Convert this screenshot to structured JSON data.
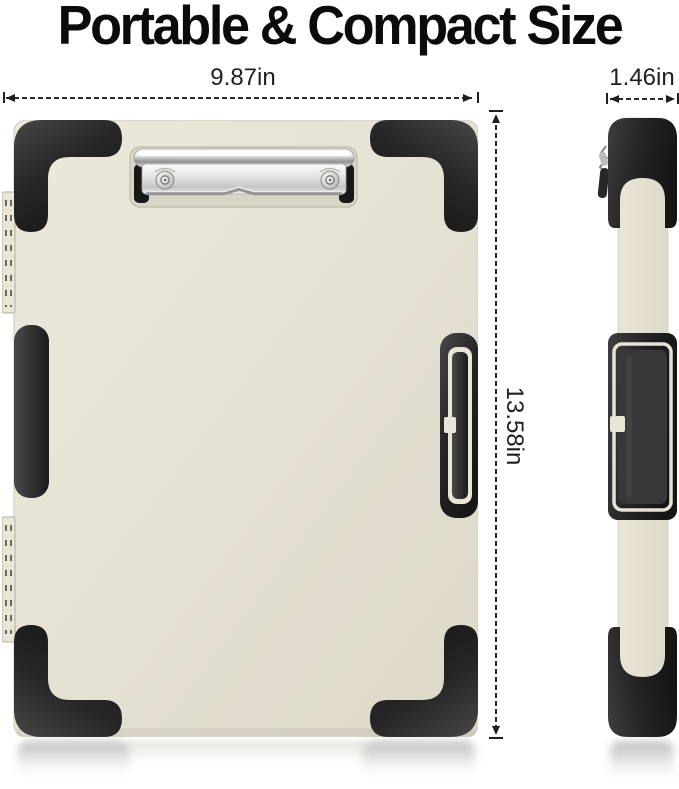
{
  "title": "Portable & Compact Size",
  "dimensions": {
    "width": "9.87in",
    "depth": "1.46in",
    "height": "13.58in"
  },
  "colors": {
    "body": "#e5e1d3",
    "trim": "#262626",
    "chrome": "#d9d9d9",
    "dimension_lines": "#1f1f1f",
    "background": "#ffffff"
  }
}
